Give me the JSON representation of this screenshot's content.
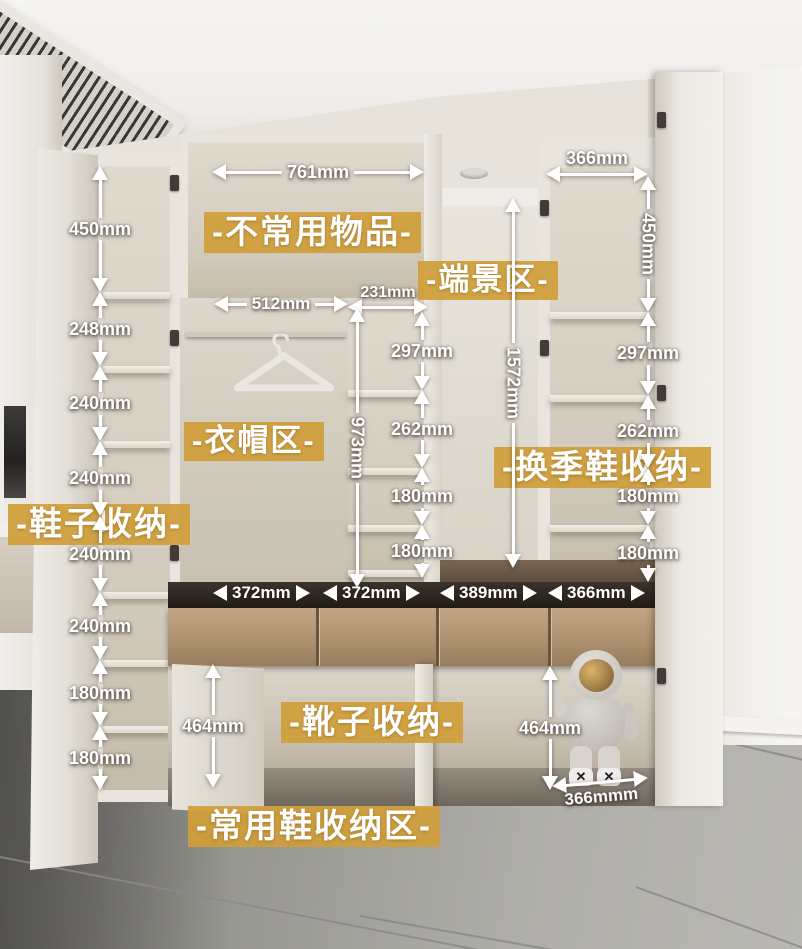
{
  "zones": {
    "shoe_storage": "-鞋子收纳-",
    "infrequent_items": "-不常用物品-",
    "clothing_area": "-衣帽区-",
    "end_scene_area": "-端景区-",
    "seasonal_shoe_storage": "-换季鞋收纳-",
    "boot_storage": "-靴子收纳-",
    "daily_shoe_storage_area": "-常用鞋收纳区-"
  },
  "m": {
    "left": [
      "450mm",
      "248mm",
      "240mm",
      "240mm",
      "240mm",
      "240mm",
      "180mm",
      "180mm"
    ],
    "top_cabinet_width": "761mm",
    "hanging_width": "512mm",
    "mid_column_width": "231mm",
    "hanging_height": "973mm",
    "mid": [
      "297mm",
      "262mm",
      "180mm",
      "180mm"
    ],
    "nook_height": "1572mm",
    "right_top_width": "366mm",
    "right": [
      "450mm",
      "297mm",
      "262mm",
      "180mm",
      "180mm"
    ],
    "drawers": [
      "372mm",
      "372mm",
      "389mm",
      "366mm"
    ],
    "boot_left_height": "464mm",
    "boot_right_height": "464mm",
    "boot_right_width": "366mmm"
  },
  "icons": {
    "bear_eye_glyph": "✕"
  },
  "colors": {
    "label_bg": "#d09e3a",
    "label_text": "#ffffff",
    "measure_text": "#ffffff",
    "cabinet": "#e8e4dc",
    "drawer_wood": "#ab8f6e",
    "floor_tile": "#a3a29e"
  }
}
